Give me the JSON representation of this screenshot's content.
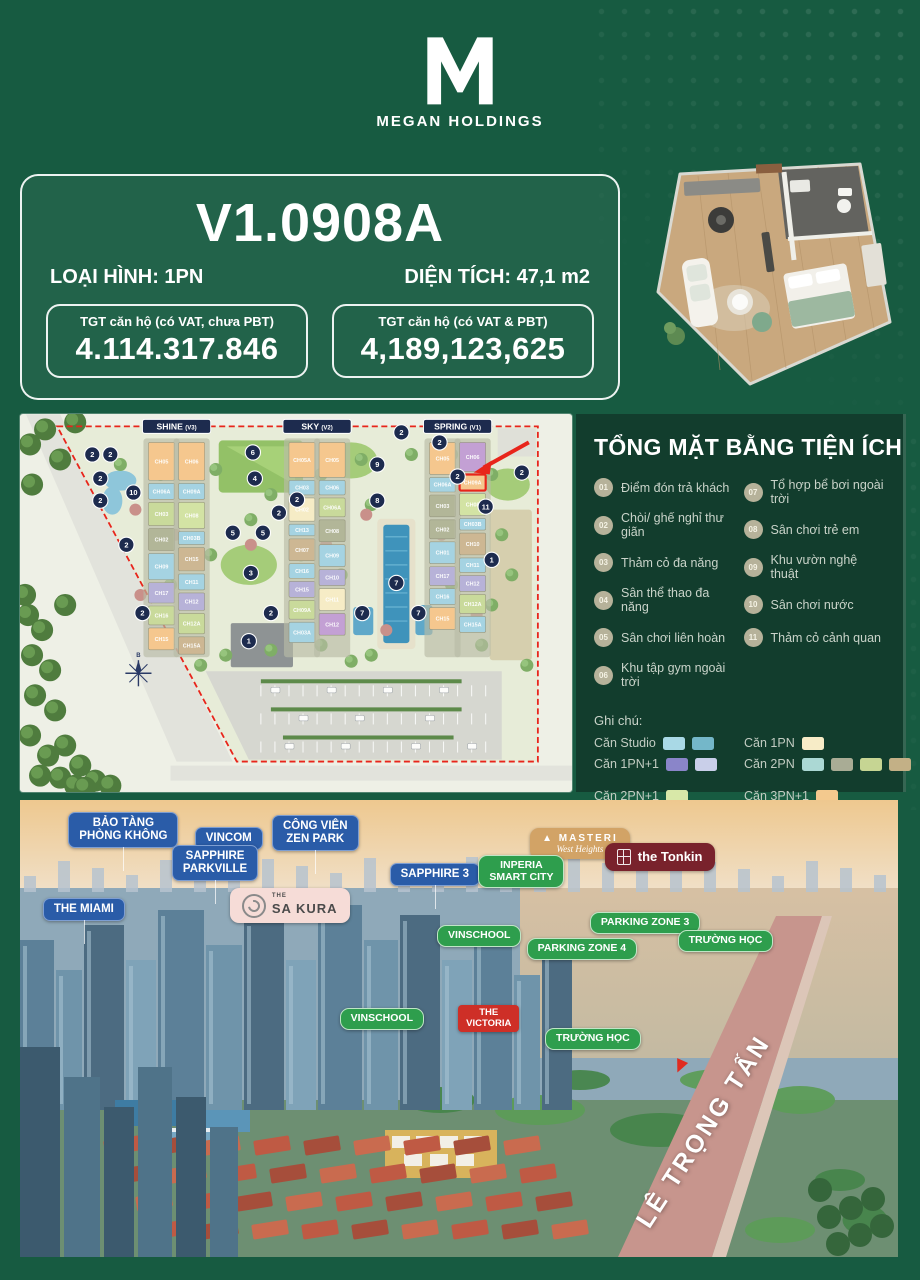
{
  "theme": {
    "page_bg": "#175b41",
    "panel_bg": "#123d2d",
    "accent_red": "#e8251b",
    "navy": "#1d2b4e"
  },
  "header": {
    "logo_letter": "M",
    "brand": "MEGAN HOLDINGS"
  },
  "unit_card": {
    "code": "V1.0908A",
    "type_label": "LOẠI HÌNH: 1PN",
    "area_label": "DIỆN TÍCH: 47,1 m2",
    "price_boxes": [
      {
        "label": "TGT căn hộ (có VAT, chưa PBT)",
        "value": "4.114.317.846"
      },
      {
        "label": "TGT căn hộ (có VAT & PBT)",
        "value": "4,189,123,625"
      }
    ]
  },
  "amenities": {
    "title": "TỔNG MẶT BẰNG TIỆN ÍCH",
    "items": [
      {
        "num": "01",
        "label": "Điểm đón trả khách"
      },
      {
        "num": "02",
        "label": "Chòi/ ghế nghỉ thư giãn"
      },
      {
        "num": "03",
        "label": "Thảm cỏ đa năng"
      },
      {
        "num": "04",
        "label": "Sân thể thao đa năng"
      },
      {
        "num": "05",
        "label": "Sân chơi liên hoàn"
      },
      {
        "num": "06",
        "label": "Khu tập gym ngoài trời"
      },
      {
        "num": "07",
        "label": "Tổ hợp bể bơi ngoài trời"
      },
      {
        "num": "08",
        "label": "Sân chơi trẻ em"
      },
      {
        "num": "09",
        "label": "Khu vườn nghệ thuật"
      },
      {
        "num": "10",
        "label": "Sân chơi nước"
      },
      {
        "num": "11",
        "label": "Thảm cỏ cảnh quan"
      }
    ],
    "legend_title": "Ghi chú:",
    "legend": [
      {
        "label": "Căn Studio",
        "swatches": [
          "#a9d9e6",
          "#74b7c9"
        ]
      },
      {
        "label": "Căn 1PN",
        "swatches": [
          "#f7ecc7"
        ]
      },
      {
        "label": "Căn 1PN+1",
        "swatches": [
          "#8a85c9",
          "#c9cfe9"
        ]
      },
      {
        "label": "Căn 2PN",
        "swatches": [
          "#abd8d4",
          "#a9ac95",
          "#c6d593",
          "#c3b086"
        ]
      },
      {
        "label": "Căn 2PN+1",
        "swatches": [
          "#d8e8a8"
        ],
        "gap": true
      },
      {
        "label": "Căn 3PN+1",
        "swatches": [
          "#f3c98e"
        ],
        "gap": true
      },
      {
        "label": "Căn 3 PN",
        "swatches": [
          "#d6abd9"
        ]
      },
      {
        "label": "Diện tích hầm để xe",
        "swatches": [],
        "dashed": true
      }
    ]
  },
  "site_map": {
    "colors": {
      "orange": "#f5c78e",
      "blue": "#a5d3e2",
      "green": "#c9da9b",
      "sage": "#b2b698",
      "cream": "#f6ecc6",
      "lav": "#b7b2d8",
      "purple": "#c3a0d4",
      "tan": "#cdb793",
      "ltgreen": "#d3e3a4"
    },
    "highlight_unit": "CH09A",
    "groups": [
      {
        "name": "SHINE",
        "tag": "(V3)",
        "badge_x": 156,
        "strips": [
          {
            "x": 128,
            "blocks": [
              [
                "CH05",
                "orange",
                26
              ],
              [
                "CH06A",
                "blue",
                11
              ],
              [
                "CH03",
                "green",
                16
              ],
              [
                "CH02",
                "sage",
                15
              ],
              [
                "CH09",
                "blue",
                18
              ],
              [
                "CH17",
                "lav",
                14
              ],
              [
                "CH16",
                "green",
                13
              ],
              [
                "CH15",
                "orange",
                15
              ]
            ]
          },
          {
            "x": 158,
            "blocks": [
              [
                "CH06",
                "orange",
                26
              ],
              [
                "CH09A",
                "blue",
                11
              ],
              [
                "CH08",
                "ltgreen",
                18
              ],
              [
                "CH03B",
                "blue",
                9
              ],
              [
                "CH15",
                "tan",
                16
              ],
              [
                "CH11",
                "blue",
                11
              ],
              [
                "CH12",
                "lav",
                12
              ],
              [
                "CH12A",
                "green",
                14
              ],
              [
                "CH15A",
                "tan",
                12
              ]
            ]
          }
        ]
      },
      {
        "name": "SKY",
        "tag": "(V2)",
        "badge_x": 296,
        "strips": [
          {
            "x": 268,
            "blocks": [
              [
                "CH05A",
                "orange",
                24
              ],
              [
                "CH03",
                "blue",
                10
              ],
              [
                "CH02",
                "cream",
                16
              ],
              [
                "CH13",
                "blue",
                8
              ],
              [
                "CH07",
                "tan",
                15
              ],
              [
                "CH16",
                "blue",
                10
              ],
              [
                "CH15",
                "lav",
                11
              ],
              [
                "CH09A",
                "green",
                13
              ],
              [
                "CH03A",
                "blue",
                14
              ]
            ]
          },
          {
            "x": 298,
            "blocks": [
              [
                "CH05",
                "orange",
                24
              ],
              [
                "CH06",
                "blue",
                10
              ],
              [
                "CH06A",
                "green",
                13
              ],
              [
                "CH08",
                "sage",
                15
              ],
              [
                "CH09",
                "blue",
                15
              ],
              [
                "CH10",
                "lav",
                11
              ],
              [
                "CH11",
                "cream",
                15
              ],
              [
                "CH12",
                "purple",
                15
              ]
            ]
          }
        ]
      },
      {
        "name": "SPRING",
        "tag": "(V1)",
        "badge_x": 436,
        "strips": [
          {
            "x": 408,
            "blocks": [
              [
                "CH05",
                "orange",
                22
              ],
              [
                "CH06A",
                "blue",
                10
              ],
              [
                "CH03",
                "sage",
                15
              ],
              [
                "CH02",
                "sage",
                13
              ],
              [
                "CH01",
                "blue",
                15
              ],
              [
                "CH17",
                "lav",
                13
              ],
              [
                "CH16",
                "blue",
                11
              ],
              [
                "CH15",
                "orange",
                15
              ]
            ]
          },
          {
            "x": 438,
            "blocks": [
              [
                "CH06",
                "purple",
                20
              ],
              [
                "CH09A",
                "orange",
                11,
                "highlight"
              ],
              [
                "CH08",
                "ltgreen",
                15
              ],
              [
                "CH03B",
                "blue",
                8
              ],
              [
                "CH10",
                "tan",
                15
              ],
              [
                "CH11",
                "blue",
                10
              ],
              [
                "CH12",
                "lav",
                11
              ],
              [
                "CH12A",
                "green",
                13
              ],
              [
                "CH15A",
                "blue",
                11
              ]
            ]
          }
        ]
      }
    ],
    "markers": [
      [
        2,
        72,
        40
      ],
      [
        2,
        90,
        40
      ],
      [
        2,
        80,
        64
      ],
      [
        2,
        80,
        86
      ],
      [
        10,
        113,
        78
      ],
      [
        2,
        106,
        130
      ],
      [
        2,
        122,
        198
      ],
      [
        6,
        232,
        38
      ],
      [
        4,
        234,
        64
      ],
      [
        5,
        212,
        118
      ],
      [
        5,
        242,
        118
      ],
      [
        2,
        258,
        98
      ],
      [
        3,
        230,
        158
      ],
      [
        2,
        250,
        198
      ],
      [
        1,
        228,
        226
      ],
      [
        2,
        276,
        85
      ],
      [
        9,
        356,
        50
      ],
      [
        8,
        356,
        86
      ],
      [
        2,
        380,
        18
      ],
      [
        7,
        375,
        168
      ],
      [
        7,
        341,
        198
      ],
      [
        7,
        397,
        198
      ],
      [
        2,
        418,
        28
      ],
      [
        2,
        436,
        62
      ],
      [
        11,
        464,
        92
      ],
      [
        1,
        470,
        145
      ],
      [
        2,
        500,
        58
      ]
    ]
  },
  "aerial": {
    "labels": [
      {
        "id": "bao-tang-phong-khong",
        "style": "blue",
        "lines": [
          "BẢO TÀNG",
          "PHÒNG KHÔNG"
        ],
        "x": 5.5,
        "y": 2.6
      },
      {
        "id": "vincom",
        "style": "blue",
        "lines": [
          "VINCOM"
        ],
        "x": 19.9,
        "y": 5.9
      },
      {
        "id": "cong-vien-zen-park",
        "style": "blue",
        "lines": [
          "CÔNG VIÊN",
          "ZEN PARK"
        ],
        "x": 28.7,
        "y": 3.3
      },
      {
        "id": "sapphire-parkville",
        "style": "blue",
        "lines": [
          "SAPPHIRE",
          "PARKVILLE"
        ],
        "x": 17.3,
        "y": 9.8
      },
      {
        "id": "sapphire-3",
        "style": "blue",
        "lines": [
          "SAPPHIRE 3"
        ],
        "x": 42.1,
        "y": 13.8
      },
      {
        "id": "the-miami",
        "style": "blue",
        "lines": [
          "THE MIAMI"
        ],
        "x": 2.6,
        "y": 21.4
      },
      {
        "id": "the-sakura",
        "style": "pink",
        "lines": [
          "THE",
          "SA KURA"
        ],
        "x": 23.9,
        "y": 19.3
      },
      {
        "id": "masteri-west-heights",
        "style": "tan",
        "lines": [
          "MASTERI",
          "West Heights"
        ],
        "x": 58.1,
        "y": 6.1
      },
      {
        "id": "the-tonkin",
        "style": "darkred",
        "lines": [
          "the Tonkin"
        ],
        "x": 66.6,
        "y": 9.4
      },
      {
        "id": "inperia-smart-city",
        "style": "green",
        "lines": [
          "INPERIA",
          "SMART CITY"
        ],
        "x": 52.2,
        "y": 12.0
      },
      {
        "id": "parking-zone-3",
        "style": "green",
        "lines": [
          "PARKING ZONE 3"
        ],
        "x": 64.9,
        "y": 24.5
      },
      {
        "id": "truong-hoc-1",
        "style": "green",
        "lines": [
          "TRƯỜNG HỌC"
        ],
        "x": 74.9,
        "y": 28.4
      },
      {
        "id": "parking-zone-4",
        "style": "green",
        "lines": [
          "PARKING ZONE 4"
        ],
        "x": 57.7,
        "y": 30.2
      },
      {
        "id": "vinschool-1",
        "style": "green",
        "lines": [
          "VINSCHOOL"
        ],
        "x": 47.5,
        "y": 27.4
      },
      {
        "id": "vinschool-2",
        "style": "green",
        "lines": [
          "VINSCHOOL"
        ],
        "x": 36.4,
        "y": 45.5
      },
      {
        "id": "the-victoria",
        "style": "red",
        "lines": [
          "THE",
          "VICTORIA"
        ],
        "x": 49.9,
        "y": 44.9
      },
      {
        "id": "truong-hoc-2",
        "style": "green",
        "lines": [
          "TRƯỜNG HỌC"
        ],
        "x": 59.8,
        "y": 49.9
      }
    ],
    "road_label": "LÊ TRỌNG TẤN"
  }
}
